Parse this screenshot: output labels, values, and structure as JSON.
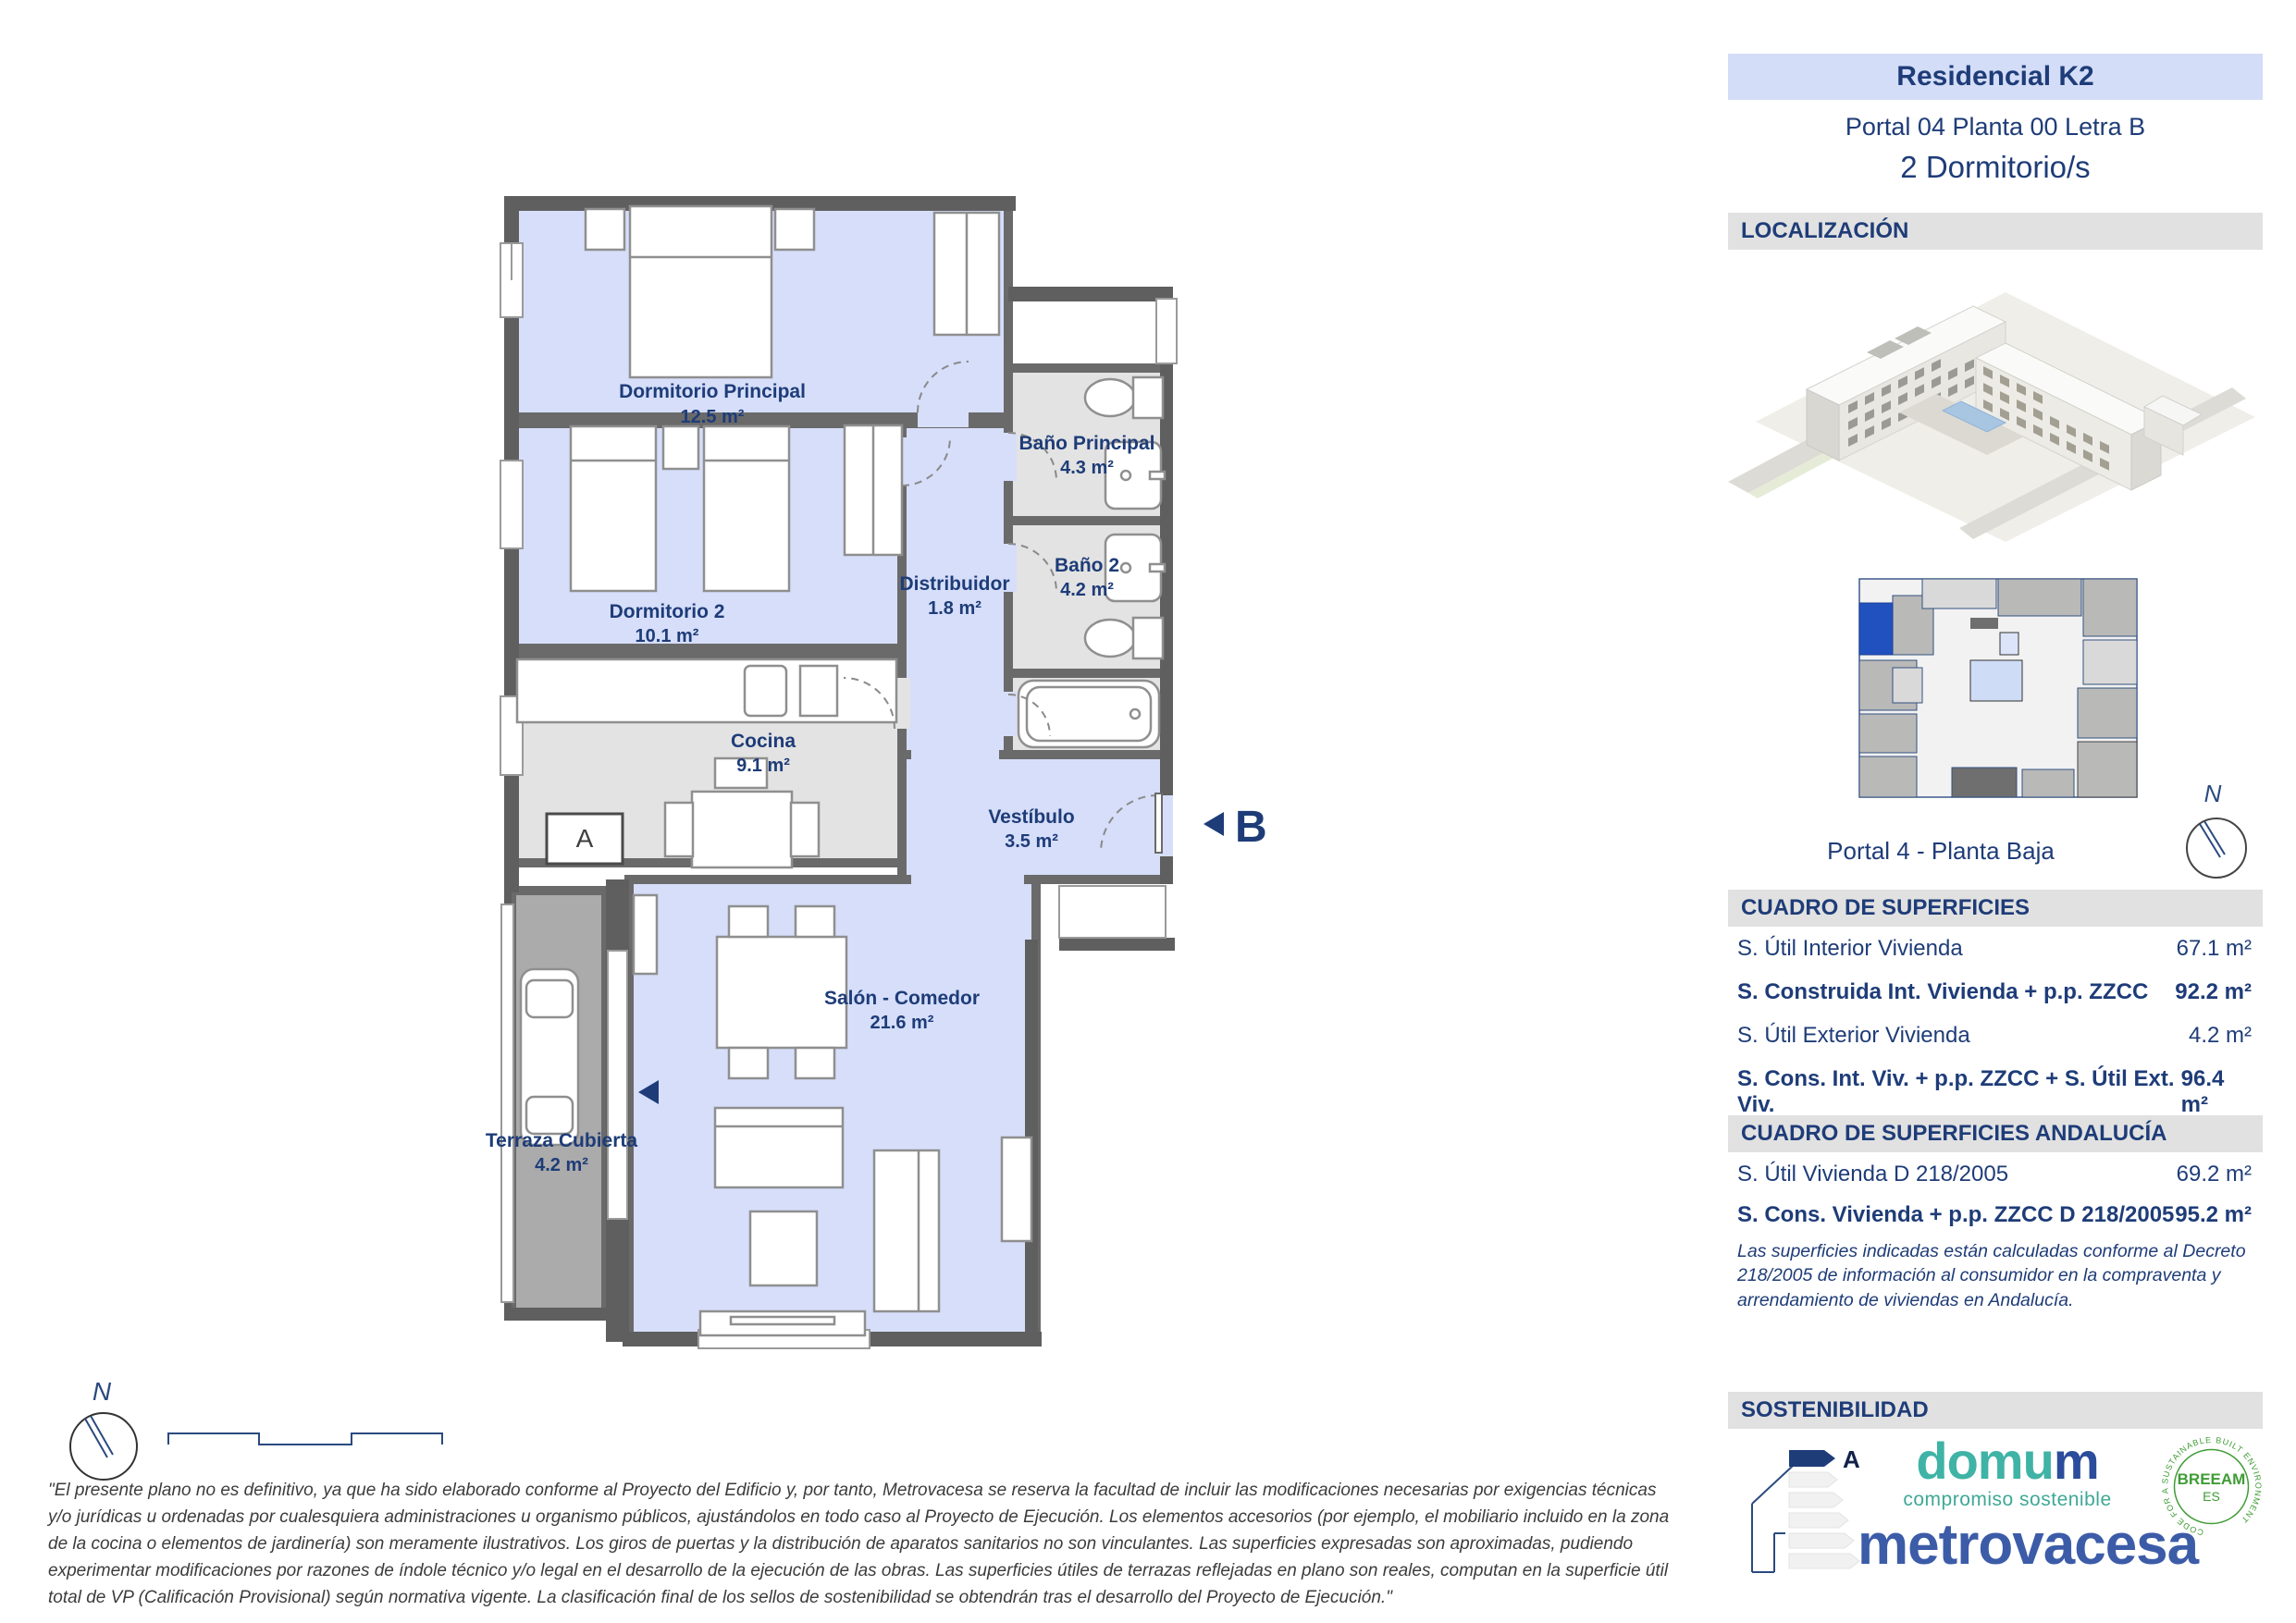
{
  "panel": {
    "title": "Residencial K2",
    "subtitle": "Portal 04 Planta 00 Letra B",
    "bedrooms": "2 Dormitorio/s",
    "localizacion_header": "LOCALIZACIÓN",
    "keyplan_caption": "Portal 4 - Planta Baja",
    "surfaces": {
      "header": "CUADRO DE SUPERFICIES",
      "rows": [
        {
          "label": "S. Útil Interior Vivienda",
          "value": "67.1 m²"
        },
        {
          "label": "S. Construida Int. Vivienda + p.p. ZZCC",
          "value": "92.2 m²"
        },
        {
          "label": "S. Útil Exterior Vivienda",
          "value": "4.2 m²"
        },
        {
          "label": "S. Cons. Int. Viv. + p.p. ZZCC + S. Útil Ext. Viv.",
          "value": "96.4 m²"
        }
      ]
    },
    "surfaces_andalucia": {
      "header": "CUADRO DE SUPERFICIES ANDALUCÍA",
      "rows": [
        {
          "label": "S. Útil Vivienda D 218/2005",
          "value": "69.2 m²"
        },
        {
          "label": "S. Cons. Vivienda + p.p. ZZCC D 218/2005",
          "value": "95.2 m²"
        }
      ],
      "note": "Las superficies indicadas están calculadas conforme al Decreto 218/2005 de información al consumidor en la compraventa y arrendamiento de viviendas en Andalucía."
    },
    "sostenibilidad": {
      "header": "SOSTENIBILIDAD",
      "energy_rating": "A",
      "domum_part1": "domu",
      "domum_part2": "m",
      "domum_tagline": "compromiso sostenible",
      "metrovacesa": "metrovacesa",
      "breeam_line1": "BREEAM",
      "breeam_line2": "ES",
      "breeam_ring": "CODE FOR A SUSTAINABLE BUILT ENVIRONMENT"
    }
  },
  "plan": {
    "rooms": [
      {
        "name": "Dormitorio Principal",
        "area": "12.5 m²"
      },
      {
        "name": "Dormitorio 2",
        "area": "10.1 m²"
      },
      {
        "name": "Baño Principal",
        "area": "4.3 m²"
      },
      {
        "name": "Baño 2",
        "area": "4.2 m²"
      },
      {
        "name": "Distribuidor",
        "area": "1.8 m²"
      },
      {
        "name": "Cocina",
        "area": "9.1 m²"
      },
      {
        "name": "Vestíbulo",
        "area": "3.5 m²"
      },
      {
        "name": "Salón - Comedor",
        "area": "21.6 m²"
      },
      {
        "name": "Terraza Cubierta",
        "area": "4.2 m²"
      }
    ],
    "markers": {
      "section_a": "A",
      "entry": "B"
    }
  },
  "compass": {
    "n": "N"
  },
  "colors": {
    "accent_navy": "#1e3c78",
    "room_blue": "#d6defa",
    "wet_gray": "#e3e3e3",
    "terrace_gray": "#ababab",
    "wall_gray": "#5f5f5f",
    "keyplan_highlight": "#2151be",
    "domum_teal": "#3fb3a5",
    "breeam_green": "#3f9c35",
    "metrovacesa_blue": "#3c5ca8"
  },
  "disclaimer": "\"El presente plano no es definitivo, ya que ha sido elaborado conforme al Proyecto del Edificio y, por tanto, Metrovacesa se reserva la facultad de incluir las modificaciones necesarias por exigencias técnicas y/o jurídicas u ordenadas por cualesquiera administraciones u organismo públicos, ajustándolos en todo caso al Proyecto de Ejecución. Los elementos accesorios (por ejemplo, el mobiliario incluido en la zona de la cocina o elementos de jardinería) son meramente ilustrativos. Los giros de puertas y la distribución de aparatos sanitarios no son vinculantes. Las superficies expresadas son aproximadas, pudiendo experimentar modificaciones por razones de índole técnico y/o legal en el desarrollo de la ejecución de las obras. Las superficies útiles de terrazas reflejadas en plano son reales, computan en la superficie útil total de VP (Calificación Provisional) según normativa vigente. La clasificación final de los sellos de sostenibilidad se obtendrán tras el desarrollo del Proyecto de Ejecución.\""
}
